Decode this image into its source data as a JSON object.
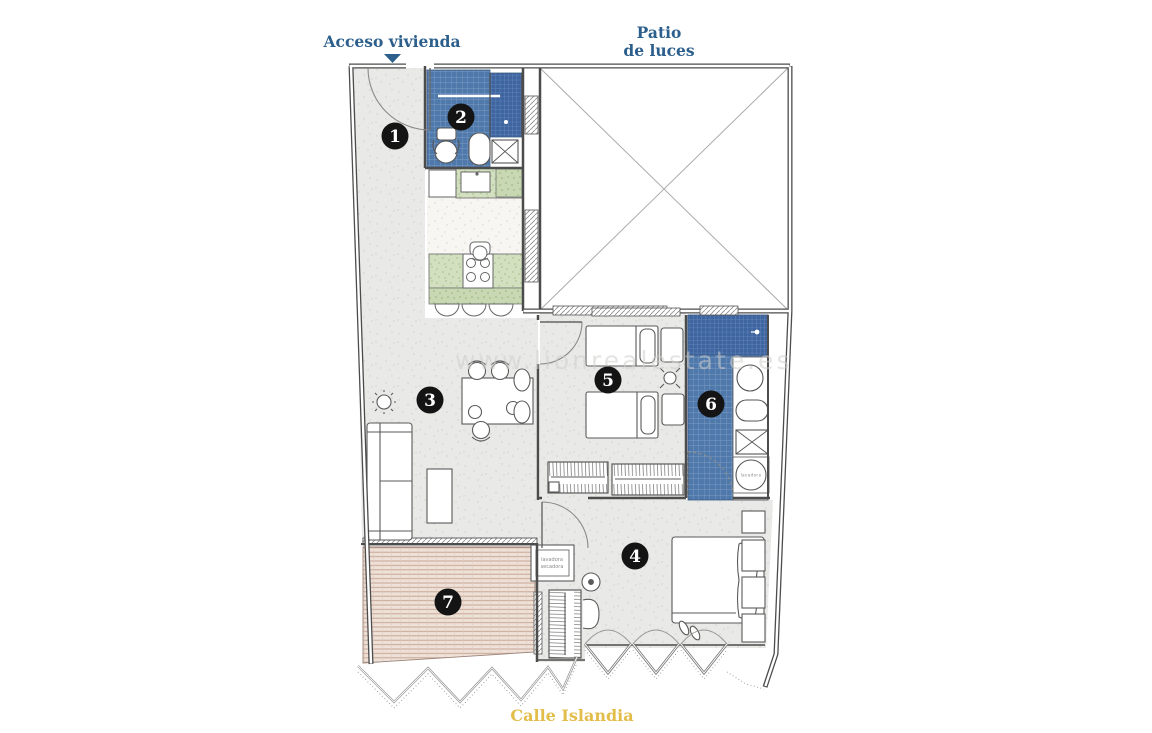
{
  "labels": {
    "access": "Acceso vivienda",
    "patio": [
      "Patio",
      "de luces"
    ],
    "street": "Calle Islandia"
  },
  "watermark": "www.lionrealestate.es",
  "rooms": [
    {
      "number": "1"
    },
    {
      "number": "2"
    },
    {
      "number": "3"
    },
    {
      "number": "4"
    },
    {
      "number": "5"
    },
    {
      "number": "6"
    },
    {
      "number": "7"
    }
  ],
  "appliances": {
    "laundry_cabinet": [
      "lavadora",
      "secadora"
    ],
    "washer_drum_label": "lavadora"
  },
  "colors": {
    "label_blue": "#2d5f8d",
    "street_yellow": "#e3bd4a",
    "tile_blue": "#4f79ab",
    "tile_blue_dark": "#3e65a0",
    "kitchen_green": "#d2e0c0",
    "floor_gray": "#e9e9e7",
    "terrace_tan": "#eee2d8",
    "terrace_line": "#c59e8e",
    "wall": "#4c4c4c",
    "badge": "#141414"
  }
}
